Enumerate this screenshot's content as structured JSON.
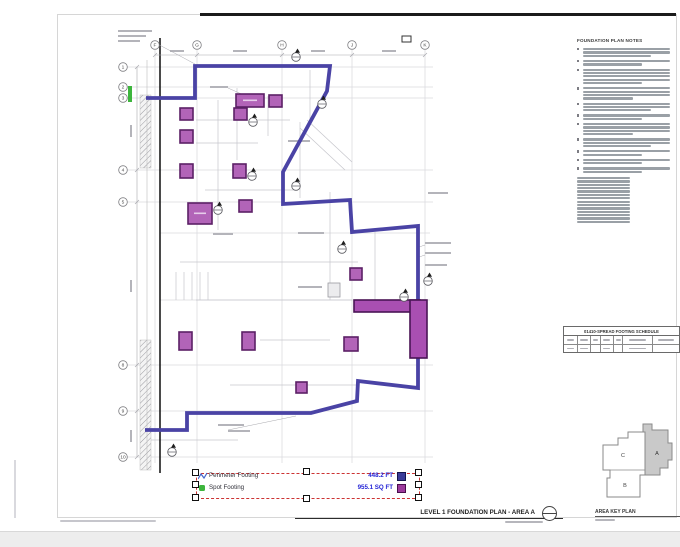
{
  "titles": {
    "drawing": "LEVEL 1 FOUNDATION PLAN - AREA A",
    "area_key": "AREA KEY PLAN",
    "notes": "FOUNDATION PLAN NOTES",
    "schedule": "01410-SPREAD FOOTING SCHEDULE"
  },
  "legend": {
    "perimeter": {
      "label": "Perimeter Footing",
      "value": "448.2 FT"
    },
    "spot": {
      "label": "Spot Footing",
      "value": "955.1 SQ FT"
    }
  },
  "area_key": {
    "label_a": "A",
    "label_b": "B",
    "label_c": "C"
  },
  "grid": {
    "top_labels": [
      "F",
      "G",
      "H",
      "J",
      "K"
    ],
    "top_x": [
      155,
      197,
      282,
      352,
      425
    ],
    "top_y": 45,
    "left_labels": [
      "1",
      "2",
      "3",
      "4",
      "5",
      "8",
      "9",
      "10"
    ],
    "left_y": [
      67,
      87,
      98,
      170,
      202,
      365,
      411,
      457
    ],
    "left_x": 123
  },
  "plan": {
    "outline_points": "146,98 195,98 195,66 330,66 327,91 283,172 283,204 350,200 352,232 418,226 418,388 358,381 357,401 311,413 187,413 187,430 145,430",
    "footings": [
      [
        236,
        94,
        28,
        13
      ],
      [
        269,
        95,
        13,
        12
      ],
      [
        234,
        108,
        13,
        12
      ],
      [
        180,
        108,
        13,
        12
      ],
      [
        180,
        130,
        13,
        13
      ],
      [
        180,
        164,
        13,
        14
      ],
      [
        233,
        164,
        13,
        14
      ],
      [
        239,
        200,
        13,
        12
      ],
      [
        188,
        203,
        24,
        21
      ],
      [
        350,
        268,
        12,
        12
      ],
      [
        344,
        337,
        14,
        14
      ],
      [
        179,
        332,
        13,
        18
      ],
      [
        242,
        332,
        13,
        18
      ],
      [
        296,
        382,
        11,
        11
      ]
    ],
    "strip_footings": [
      [
        354,
        300,
        66,
        12
      ],
      [
        410,
        300,
        17,
        58
      ]
    ],
    "unhighlighted_footing": [
      328,
      283,
      12,
      14
    ],
    "detail_markers": [
      [
        296,
        57
      ],
      [
        322,
        104
      ],
      [
        253,
        122
      ],
      [
        296,
        186
      ],
      [
        252,
        176
      ],
      [
        218,
        210
      ],
      [
        342,
        249
      ],
      [
        404,
        297
      ],
      [
        428,
        281
      ],
      [
        172,
        452
      ]
    ],
    "green_marker": [
      128,
      86,
      4,
      16
    ],
    "keynote_box": [
      402,
      36,
      9,
      6
    ]
  },
  "notes_panel": {
    "paragraph_lines": [
      3,
      2,
      5,
      4,
      3,
      2,
      4,
      3,
      2,
      2,
      2
    ],
    "list_lines": 14
  },
  "colors": {
    "perimeter_line": "#4a43a5",
    "spot_fill": "#b264b8",
    "spot_border": "#5b2066",
    "strip_fill": "#a94fb2",
    "strip_border": "#4a1455",
    "perimeter_swatch": "#3b3b98",
    "spot_swatch": "#9c3a9c",
    "value_text": "#2323d6",
    "selection": "#cc3333",
    "green": "#3db53d"
  }
}
